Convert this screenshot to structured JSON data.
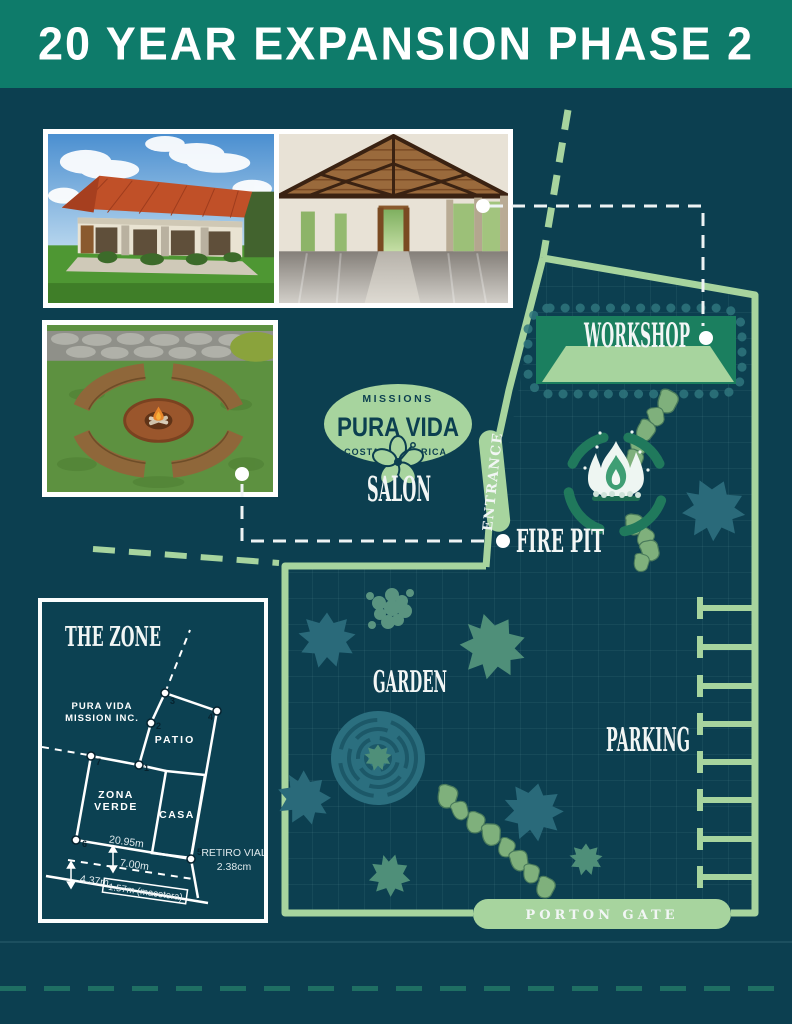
{
  "title": "20 YEAR EXPANSION PHASE 2",
  "logo": {
    "top": "MISSIONS",
    "name": "PURA VIDA",
    "left": "COSTA",
    "right": "RICA"
  },
  "map": {
    "workshop": "WORKSHOP",
    "salon": "SALON",
    "fire_pit": "FIRE PIT",
    "garden": "GARDEN",
    "parking": "PARKING",
    "entrance": "ENTRANCE",
    "gate": "PORTON GATE"
  },
  "zone": {
    "title": "THE ZONE",
    "owner1": "PURA VIDA",
    "owner2": "MISSION INC.",
    "patio": "PATIO",
    "zona1": "ZONA",
    "zona2": "VERDE",
    "casa": "CASA",
    "retiro1": "RETIRO VIAL",
    "retiro2": "2.38cm",
    "m_2095": "20.95m",
    "m_700": "7.00m",
    "m_437": "4.37m",
    "m_157": "1.57m (macetera)",
    "p1": "1",
    "p2": "2",
    "p3": "3",
    "p4": "4",
    "p5": "5",
    "p6": "6",
    "p7": "7"
  },
  "colors": {
    "background": "#0c3f50",
    "header_green": "#0e7b6a",
    "accent_green": "#a7d49e",
    "workshop_green": "#1b7f5f",
    "bush_teal": "#2a6a7a",
    "bush_green": "#4f8f79",
    "white": "#ffffff"
  }
}
